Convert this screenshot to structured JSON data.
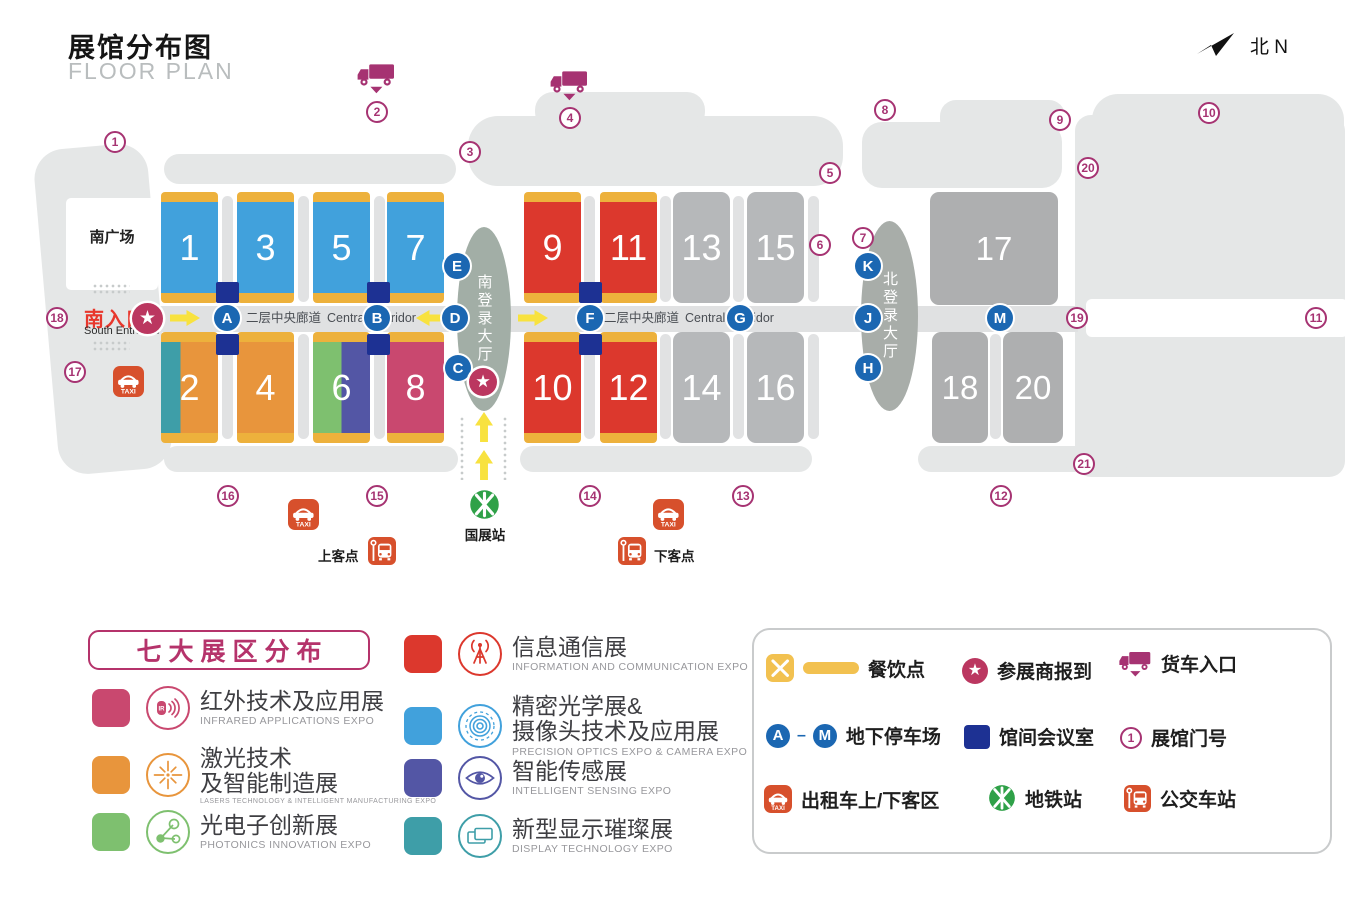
{
  "header": {
    "title_zh": "展馆分布图",
    "title_en": "FLOOR PLAN",
    "north": "北 N"
  },
  "map": {
    "south_plaza": "南广场",
    "south_entrance_zh": "南入口",
    "south_entrance_en": "South Entrance",
    "corridor_zh": "二层中央廊道",
    "corridor_en": "Central Corridor",
    "south_hall": "南登录大厅",
    "north_hall": "北登录大厅",
    "metro_station": "国展站",
    "pickup": "上客点",
    "dropoff": "下客点",
    "halls": [
      {
        "num": "1",
        "zones": [
          "optics"
        ]
      },
      {
        "num": "2",
        "zones": [
          "display",
          "laser"
        ]
      },
      {
        "num": "3",
        "zones": [
          "optics"
        ]
      },
      {
        "num": "4",
        "zones": [
          "laser"
        ]
      },
      {
        "num": "5",
        "zones": [
          "optics"
        ]
      },
      {
        "num": "6",
        "zones": [
          "photonics",
          "sensing"
        ]
      },
      {
        "num": "7",
        "zones": [
          "optics"
        ]
      },
      {
        "num": "8",
        "zones": [
          "infrared"
        ]
      },
      {
        "num": "9",
        "zones": [
          "ict"
        ]
      },
      {
        "num": "10",
        "zones": [
          "ict"
        ]
      },
      {
        "num": "11",
        "zones": [
          "ict"
        ]
      },
      {
        "num": "12",
        "zones": [
          "ict"
        ]
      },
      {
        "num": "13",
        "zones": [
          "gray"
        ]
      },
      {
        "num": "14",
        "zones": [
          "gray"
        ]
      },
      {
        "num": "15",
        "zones": [
          "gray"
        ]
      },
      {
        "num": "16",
        "zones": [
          "gray"
        ]
      },
      {
        "num": "17",
        "zones": [
          "gray2"
        ]
      },
      {
        "num": "18",
        "zones": [
          "gray2"
        ]
      },
      {
        "num": "20",
        "zones": [
          "gray2"
        ]
      }
    ],
    "parking_letters": [
      "A",
      "B",
      "C",
      "D",
      "E",
      "F",
      "G",
      "H",
      "J",
      "K",
      "M"
    ],
    "gates": [
      "1",
      "2",
      "3",
      "4",
      "5",
      "6",
      "7",
      "8",
      "9",
      "10",
      "11",
      "12",
      "13",
      "14",
      "15",
      "16",
      "17",
      "18",
      "19",
      "20",
      "21"
    ]
  },
  "zones": {
    "infrared": "#C9486F",
    "laser": "#E8953C",
    "photonics": "#7EC06F",
    "ict": "#DC382D",
    "optics": "#41A1DC",
    "sensing": "#5356A5",
    "display": "#3E9EA8",
    "gray": "#B6B8BA",
    "gray2": "#AEAFB0"
  },
  "legend_zones": {
    "title": "七大展区分布",
    "items": [
      {
        "id": "infrared",
        "zh": "红外技术及应用展",
        "en": "INFRARED APPLICATIONS EXPO"
      },
      {
        "id": "laser",
        "zh": "激光技术\n及智能制造展",
        "en": "LASERS TECHNOLOGY & INTELLIGENT MANUFACTURING EXPO"
      },
      {
        "id": "photonics",
        "zh": "光电子创新展",
        "en": "PHOTONICS INNOVATION EXPO"
      },
      {
        "id": "ict",
        "zh": "信息通信展",
        "en": "INFORMATION AND COMMUNICATION EXPO"
      },
      {
        "id": "optics",
        "zh": "精密光学展&\n摄像头技术及应用展",
        "en": "PRECISION OPTICS EXPO & CAMERA EXPO"
      },
      {
        "id": "sensing",
        "zh": "智能传感展",
        "en": "INTELLIGENT SENSING EXPO"
      },
      {
        "id": "display",
        "zh": "新型显示璀璨展",
        "en": "DISPLAY TECHNOLOGY EXPO"
      }
    ]
  },
  "legend_facilities": [
    {
      "id": "dining",
      "label": "餐饮点"
    },
    {
      "id": "checkin",
      "label": "参展商报到"
    },
    {
      "id": "truck",
      "label": "货车入口"
    },
    {
      "id": "parking",
      "label": "地下停车场",
      "from": "A",
      "to": "M"
    },
    {
      "id": "meeting",
      "label": "馆间会议室"
    },
    {
      "id": "gate",
      "label": "展馆门号",
      "sample": "1"
    },
    {
      "id": "taxi",
      "label": "出租车上/下客区"
    },
    {
      "id": "metro",
      "label": "地铁站"
    },
    {
      "id": "bus",
      "label": "公交车站"
    }
  ]
}
